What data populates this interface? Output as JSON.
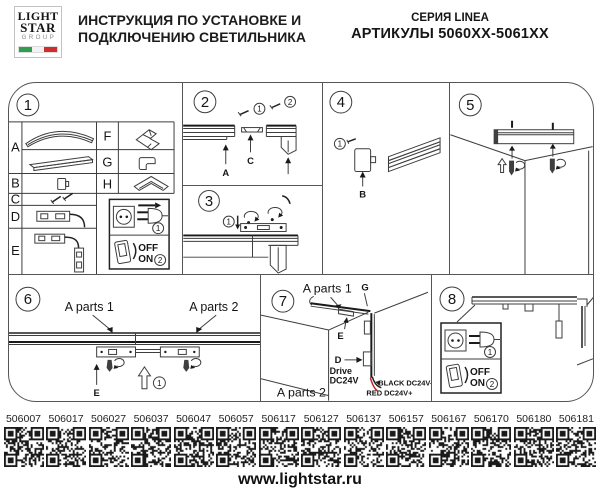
{
  "header": {
    "logo": {
      "line1": "LIGHT",
      "line2": "STAR",
      "line3": "GROUP"
    },
    "title_line1": "ИНСТРУКЦИЯ ПО УСТАНОВКЕ И",
    "title_line2": "ПОДКЛЮЧЕНИЮ СВЕТИЛЬНИКА",
    "series": "СЕРИЯ LINEA",
    "articles_range": "АРТИКУЛЫ 5060XX-5061XX"
  },
  "legend": {
    "plug_step": "1",
    "switch_step": "2",
    "off": "OFF",
    "on": "ON"
  },
  "panel1": {
    "number": "1",
    "rowA": "A",
    "rowB": "B",
    "rowC": "C",
    "rowD": "D",
    "rowE": "E",
    "rowF": "F",
    "rowG": "G",
    "rowH": "H"
  },
  "panel2": {
    "number": "2",
    "screw1": "1",
    "screw2": "2",
    "labelA": "A",
    "labelC": "C"
  },
  "panel3": {
    "number": "3",
    "screw1": "1"
  },
  "panel4": {
    "number": "4",
    "screw1": "1",
    "labelB": "B"
  },
  "panel5": {
    "number": "5"
  },
  "panel6": {
    "number": "6",
    "aparts1": "A parts 1",
    "aparts2": "A parts 2",
    "labelE": "E",
    "step1": "1"
  },
  "panel7": {
    "number": "7",
    "aparts1": "A parts 1",
    "aparts2": "A parts 2",
    "labelG": "G",
    "labelE": "E",
    "labelD": "D",
    "drive1": "Drive",
    "drive2": "DC24V",
    "wire_black": "BLACK DC24V-",
    "wire_red": "RED DC24V+"
  },
  "panel8": {
    "number": "8"
  },
  "qr_articles": [
    "506007",
    "506017",
    "506027",
    "506037",
    "506047",
    "506057",
    "506117",
    "506127",
    "506137",
    "506157",
    "506167",
    "506170",
    "506180",
    "506181"
  ],
  "footer": {
    "url": "www.lightstar.ru"
  },
  "colors": {
    "flag_green": "#2f9e4f",
    "flag_white": "#f2f2f2",
    "flag_red": "#cf2e2e",
    "wire_red": "#c42323"
  }
}
